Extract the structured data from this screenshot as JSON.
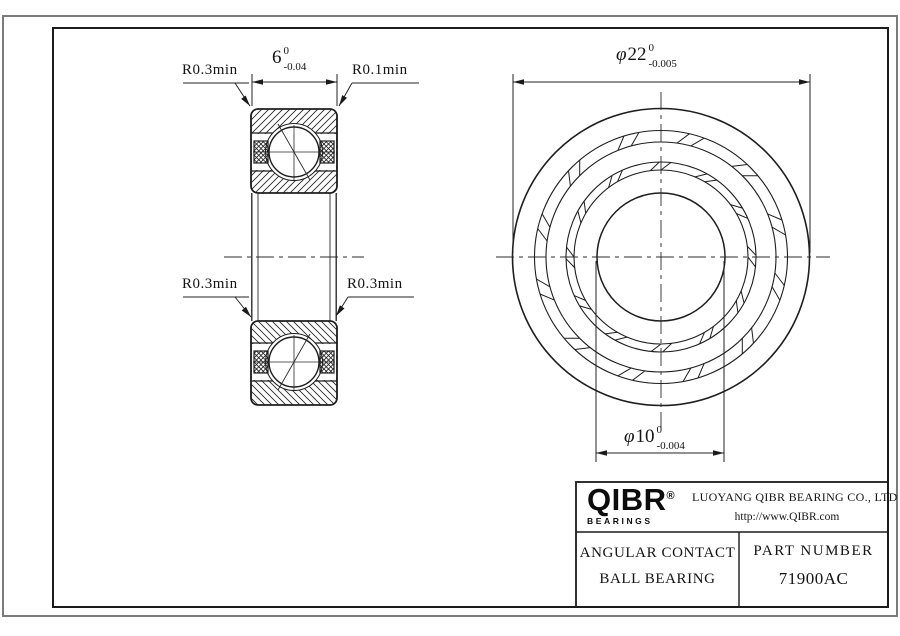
{
  "sheet": {
    "bg": "#ffffff",
    "outer_border_color": "#7b7b7b",
    "frame_color": "#1b1b1b",
    "line_color": "#1e1e1e"
  },
  "labels": {
    "fillet_top_left": "R0.3min",
    "fillet_top_right": "R0.1min",
    "fillet_mid_left": "R0.3min",
    "fillet_mid_right": "R0.3min"
  },
  "dimensions": {
    "width": {
      "value": "6",
      "tol_upper": "0",
      "tol_lower": "-0.04"
    },
    "outer_diameter": {
      "symbol": "φ",
      "value": "22",
      "tol_upper": "0",
      "tol_lower": "-0.005"
    },
    "bore_diameter": {
      "symbol": "φ",
      "value": "10",
      "tol_upper": "0",
      "tol_lower": "-0.004"
    }
  },
  "title_block": {
    "logo": {
      "brand": "QIBR",
      "registered": "®",
      "sub": "BEARINGS"
    },
    "company": "LUOYANG QIBR BEARING CO., LTD",
    "website": "http://www.QIBR.com",
    "product_line1": "ANGULAR CONTACT",
    "product_line2": "BALL BEARING",
    "part_number_label": "PART NUMBER",
    "part_number": "71900AC"
  }
}
